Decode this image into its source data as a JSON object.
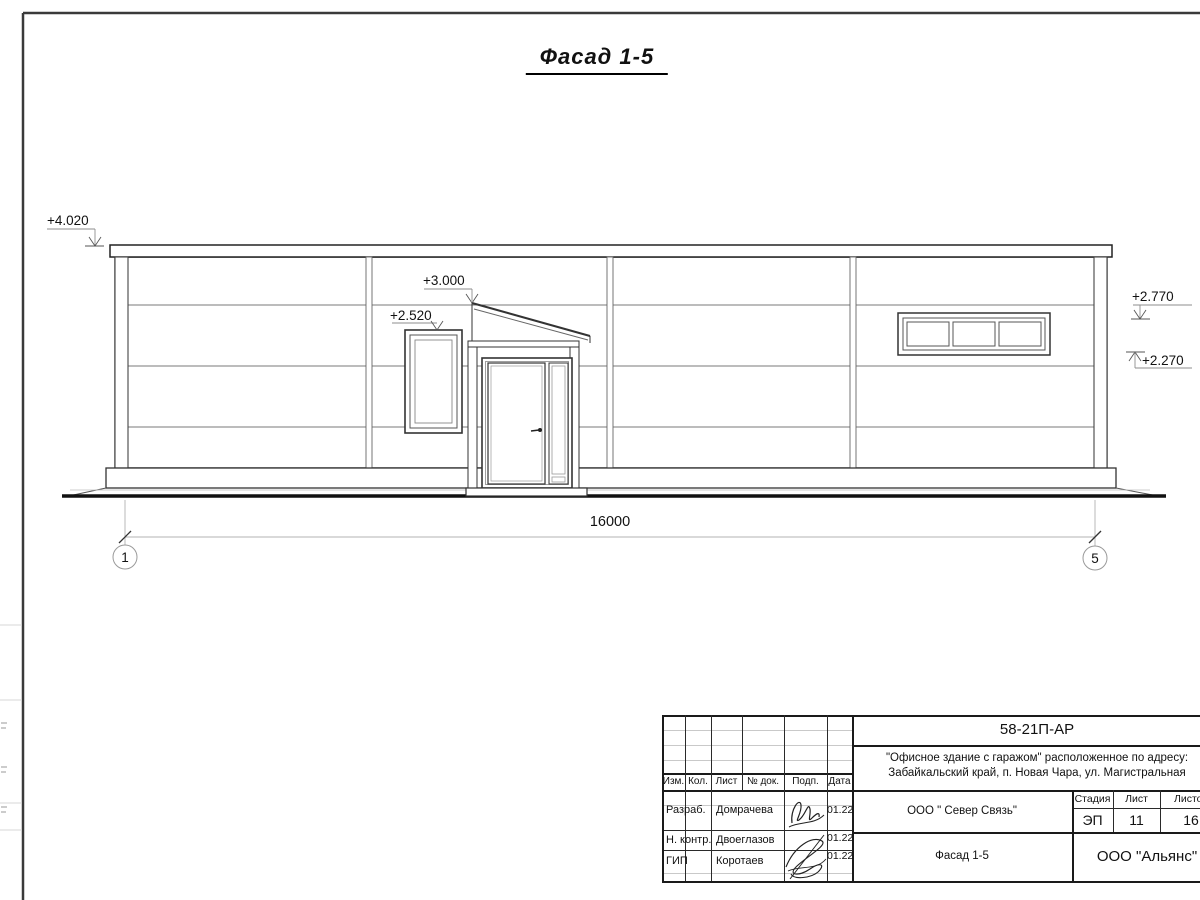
{
  "sheet": {
    "title": "Фасад 1-5"
  },
  "facade": {
    "levels": {
      "parapet": "+4.020",
      "canopy": "+3.000",
      "entry_window": "+2.520",
      "right_upper": "+2.770",
      "right_lower": "+2.270"
    },
    "dimension_total": "16000",
    "axes": {
      "left": "1",
      "right": "5"
    }
  },
  "title_block": {
    "doc_number": "58-21П-АР",
    "project_address_line1": "\"Офисное здание с гаражом\" расположенное по адресу:",
    "project_address_line2": "Забайкальский край, п. Новая Чара, ул. Магистральная",
    "header_columns": [
      "Изм.",
      "Кол.",
      "Лист",
      "№ док.",
      "Подп.",
      "Дата"
    ],
    "signers": [
      {
        "role": "Разраб.",
        "name": "Домрачева",
        "date": "01.22"
      },
      {
        "role": "Н. контр.",
        "name": "Двоеглазов",
        "date": "01.22"
      },
      {
        "role": "ГИП",
        "name": "Коротаев",
        "date": "01.22"
      }
    ],
    "contractor": "ООО \" Север Связь\"",
    "stage_label": "Стадия",
    "sheet_label": "Лист",
    "sheets_label": "Листов",
    "stage": "ЭП",
    "sheet_number": "11",
    "sheets_total": "16",
    "drawing_title": "Фасад 1-5",
    "organization": "ООО \"Альянс\""
  }
}
